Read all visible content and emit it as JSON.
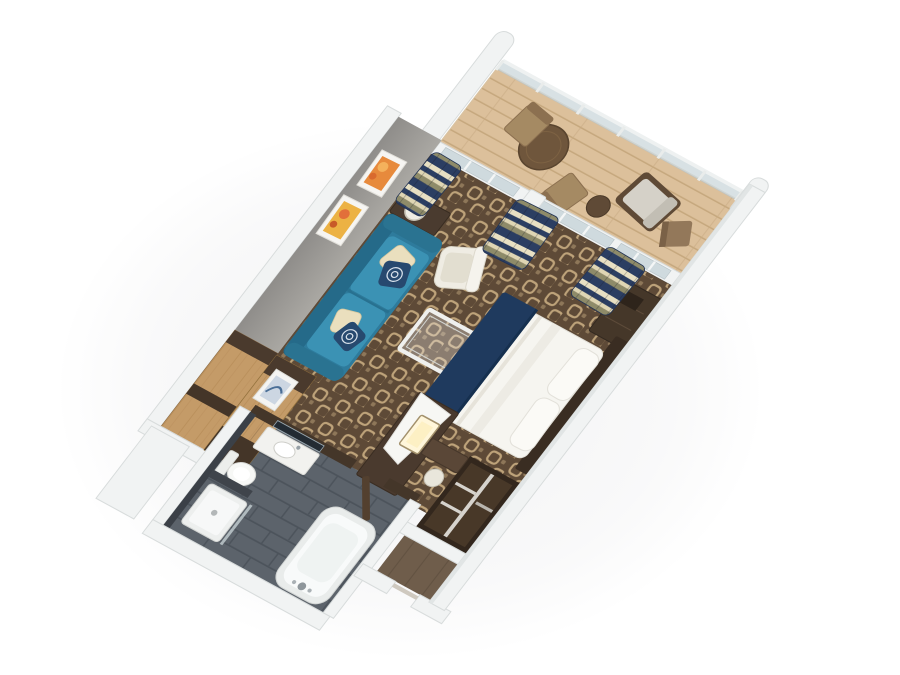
{
  "meta": {
    "title": "3D aerial floor-plan rendering of a stateroom suite with private balcony",
    "projection": "three-quarter aerial isometric view on white background",
    "background": "#ffffff"
  },
  "palette": {
    "wall_white": "#f1f3f3",
    "wall_gray": "#98958f",
    "carpet_base": "#5e4a37",
    "carpet_motif": "#c9ad82",
    "wood_oak": "#c49b68",
    "wood_dark": "#46372b",
    "wood_deck": "#dcc09b",
    "sofa_teal": "#2e7b9c",
    "pillow_cream": "#eadfbe",
    "pillow_navy": "#27496f",
    "bed_white": "#f6f5f0",
    "bed_navy": "#1f3a5e",
    "tile_slate": "#5c636b",
    "tile_dark": "#3b4047",
    "curtain_navy": "#2b3e62",
    "curtain_cream": "#e8e0c3",
    "curtain_olive": "#8e8b69",
    "glass": "#cfdade",
    "fixture_white": "#f8fafa",
    "art_orange": "#e78a3c",
    "art_gold": "#ecb244",
    "art_blue": "#ccd6e2"
  },
  "scene": {
    "rooms": [
      {
        "name": "balcony",
        "floor": "light wood decking",
        "items": [
          "glass railing",
          "curved privacy dividers",
          "round dining table",
          "two dining chairs",
          "lounge chair with cushion",
          "round side table"
        ]
      },
      {
        "name": "living-area",
        "floor": "brown patterned carpet",
        "items": [
          "teal three-seat sofa",
          "two cream pillows",
          "two navy patterned pillows",
          "glass coffee table",
          "white armchair",
          "console table with lamp",
          "oak sideboard",
          "two orange artworks",
          "one blue artwork"
        ]
      },
      {
        "name": "bedroom",
        "floor": "brown patterned carpet",
        "items": [
          "double bed with white duvet and navy runner",
          "two pillows",
          "dark headboard panel",
          "dresser",
          "vanity desk with lit mirror",
          "stool",
          "open wardrobe closet"
        ]
      },
      {
        "name": "bathroom",
        "floor": "slate tile",
        "items": [
          "vanity sink with mirror",
          "toilet",
          "shower",
          "bathtub",
          "open wood door"
        ]
      },
      {
        "name": "entry",
        "floor": "dark wood",
        "items": [
          "entry doorway"
        ]
      }
    ],
    "doors": [
      "curved sliding glass balcony door (living)",
      "curved sliding glass balcony door (bedroom)"
    ],
    "curtains": "navy, cream and olive striped drapes at both balcony doors"
  }
}
